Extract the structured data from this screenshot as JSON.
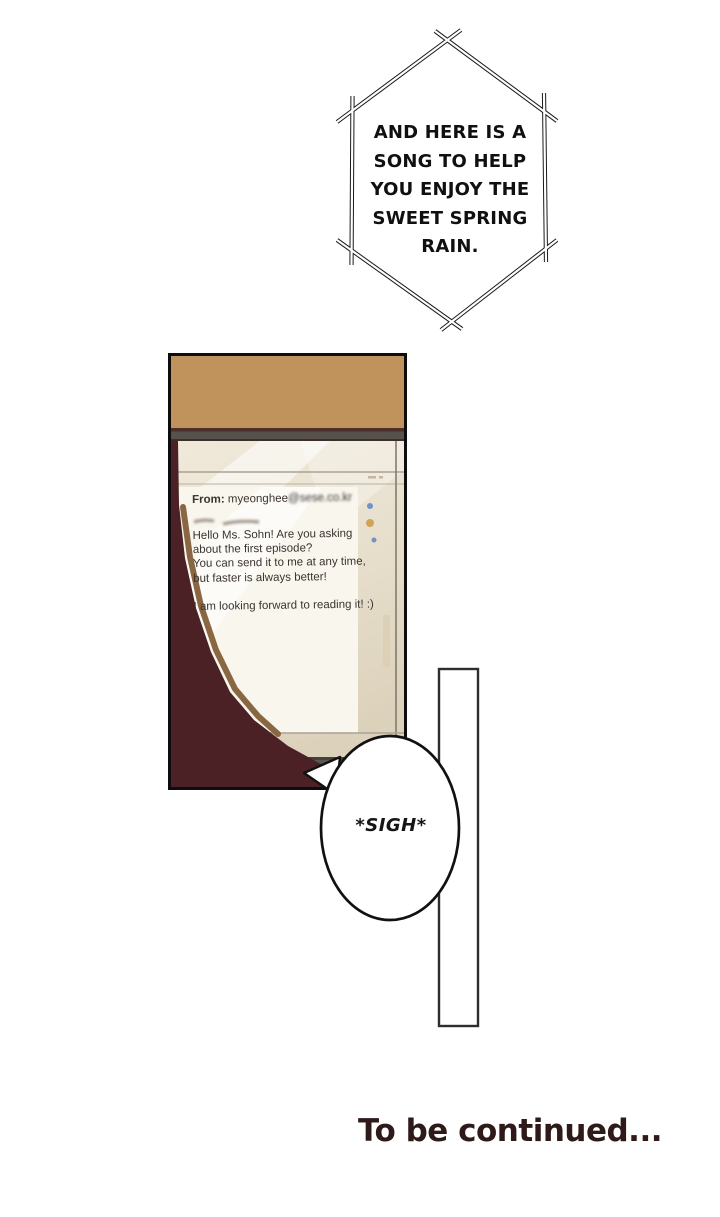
{
  "hex_bubble": {
    "lines": [
      "AND HERE IS A",
      "SONG TO HELP",
      "YOU ENJOY THE",
      "SWEET SPRING",
      "RAIN."
    ]
  },
  "panel_email": {
    "from_label": "From:",
    "from_name": " myeonghee",
    "from_domain": "@sese.co.kr",
    "body_lines": [
      "Hello Ms. Sohn! Are you asking",
      "about the first episode?",
      "You can send it to me at any time,",
      "but faster is always better!",
      "I am looking forward to reading it! :)"
    ]
  },
  "sigh_bubble": {
    "text": "*SIGH*"
  },
  "footer": {
    "text": "To be continued..."
  },
  "colors": {
    "wall_tan": "#c79a60",
    "hinge_gray": "#57514b",
    "screen_cream": "#ece4d3",
    "email_white": "#f9f6ee",
    "silhouette_maroon": "#4b2125",
    "silhouette_edge": "#8a6743",
    "laptop_bar_gray": "#5d5751",
    "desk_orange": "#bc7d44",
    "email_text": "#3b3330",
    "continued_text": "#2d1a19",
    "dot_blue": "#6f92c8",
    "dot_gold": "#d2a355",
    "chip_blue": "#7d9fd0",
    "ink": "#1a1a1a"
  }
}
